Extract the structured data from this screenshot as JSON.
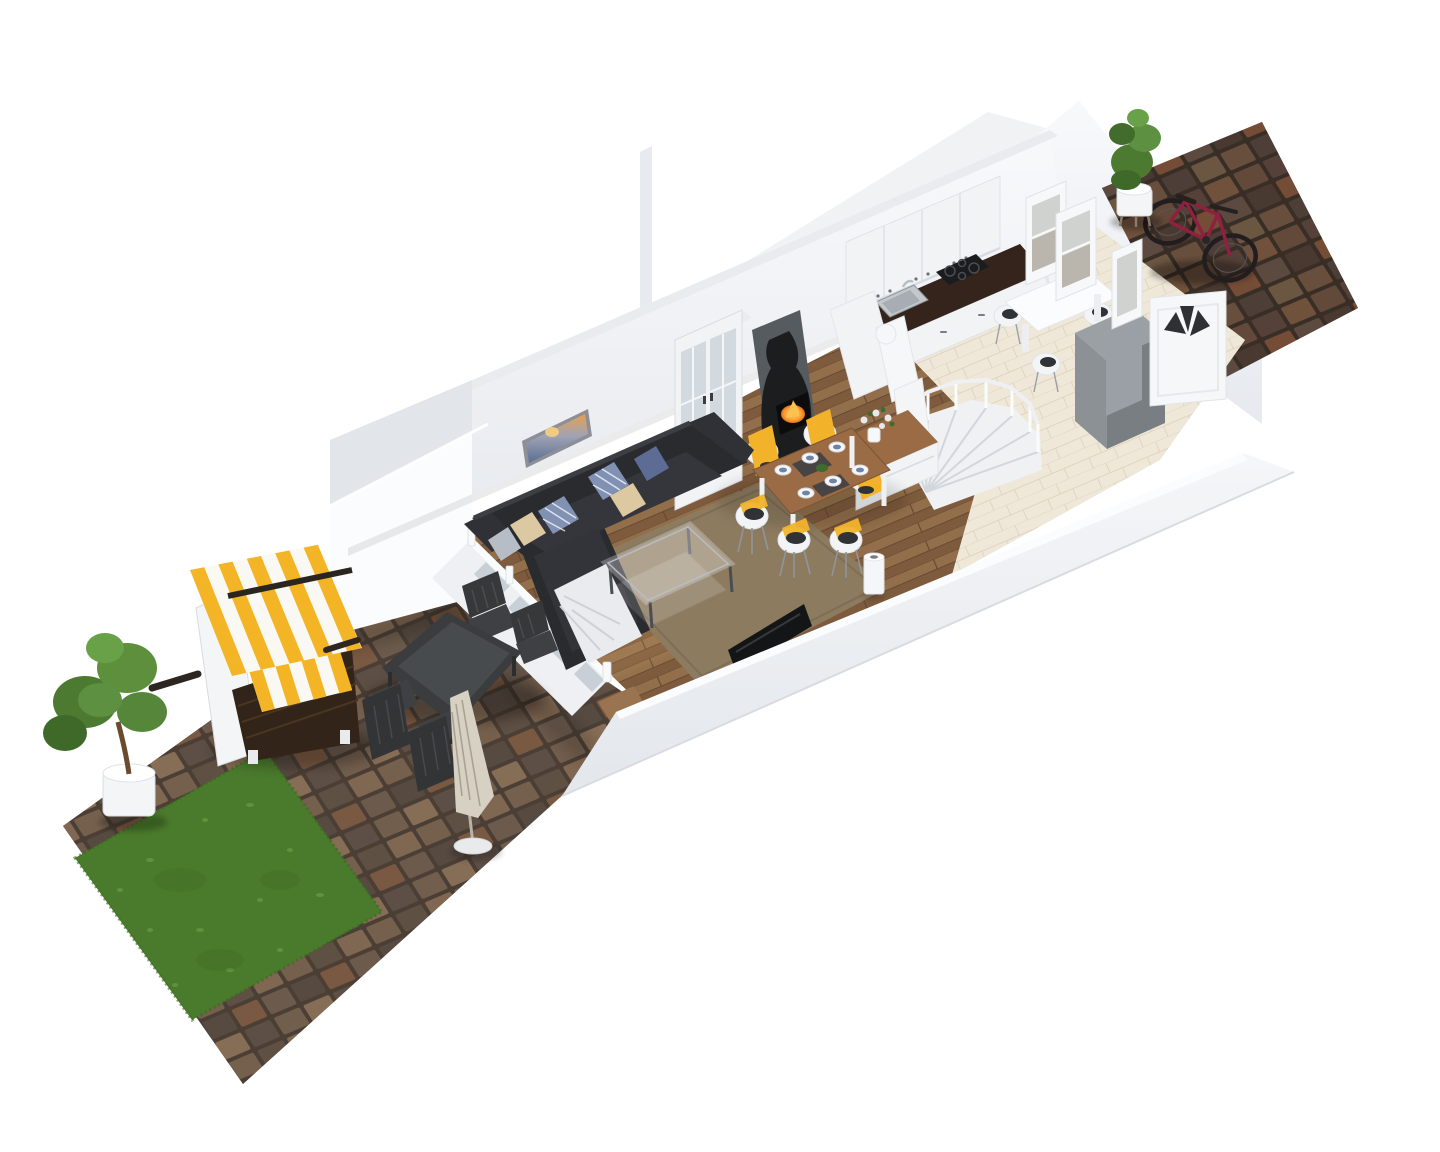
{
  "scene": {
    "description": "3D isometric floor-plan render of a narrow terraced-house ground floor, viewed diagonally from above: living room with corner sofa and dining set, kitchen with counter and spiral staircase, entrance path with bicycle, rear patio with outdoor dining set, beach chair and lawn",
    "background": "#ffffff"
  },
  "colors": {
    "wall": "#f3f4f6",
    "wall_top": "#e9ecef",
    "wall_shade": "#e2e6eb",
    "wall_bright": "#fbfcfd",
    "wood_floor": "#8a6646",
    "tile_floor": "#efe8d9",
    "rug": "#8d7b60",
    "sofa": "#2a2b2f",
    "sofa_cushion": "#35363b",
    "blanket": "#e9ebee",
    "pillow_blue": "#8091b4",
    "pillow_navy": "#5c6c94",
    "pillow_beige": "#dcc9a2",
    "pillow_gray": "#b6bdc6",
    "dining_table_wood": "#9a6b44",
    "sideboard_wood": "#9a6b44",
    "chair_shell": "#f3f4f6",
    "chair_yellow": "#f2b32b",
    "chair_seat_dark": "#2f3237",
    "counter_wood": "#34241c",
    "cabinet_white": "#f2f3f5",
    "stove_black": "#1c1d1f",
    "fire_orange": "#ff9b2e",
    "hearth_gray": "#565b5f",
    "fridge_gray": "#787e82",
    "fridge_top": "#9aa0a4",
    "fridge_side": "#8b9195",
    "stairs_white": "#eff1f3",
    "tv_black": "#141517",
    "lamp_white": "#f5f6f8",
    "picture_sky": "#e6a050",
    "picture_sea": "#5a6f92",
    "door_white": "#f6f7f9",
    "window_glass": "#cfd2cf",
    "interior_gray_wall": "#9aa0a5",
    "pavers_patio": "#584a3f",
    "pavers_path": "#3f332b",
    "grass": "#4a7a2c",
    "grass_light": "#6a9c42",
    "plant_green": "#4c7a31",
    "pot_white": "#f4f5f6",
    "strandkorb_yellow": "#f3b525",
    "strandkorb_white": "#faf8f2",
    "strandkorb_wicker": "#33241a",
    "outdoor_furniture": "#3a3c3e",
    "umbrella": "#d7d1c3",
    "bike_red": "#8e2040",
    "glass_cabinet": "#cdd5dc"
  },
  "rooms": [
    {
      "name": "living-room",
      "floor": "wood planks"
    },
    {
      "name": "dining-area",
      "floor": "wood planks"
    },
    {
      "name": "kitchen",
      "floor": "cream tile"
    },
    {
      "name": "entrance-path",
      "floor": "dark pavers"
    },
    {
      "name": "patio-garden",
      "floor": "stone pavers and lawn"
    }
  ],
  "objects": [
    {
      "name": "corner-sofa",
      "label": "dark corner sofa with plaid and knit pillows and white throw"
    },
    {
      "name": "coffee-table",
      "label": "glass coffee table"
    },
    {
      "name": "area-rug",
      "label": "brown area rug"
    },
    {
      "name": "tv",
      "label": "flat TV against front wall"
    },
    {
      "name": "floor-lamp",
      "label": "white cylinder floor lamp"
    },
    {
      "name": "wall-picture",
      "label": "sunset seascape picture"
    },
    {
      "name": "display-cabinet",
      "label": "white glass-door vitrine"
    },
    {
      "name": "wood-stove",
      "label": "black wood-burning stove with fire"
    },
    {
      "name": "dining-table",
      "label": "wood dining table set for six"
    },
    {
      "name": "dining-chairs",
      "label": "six white shell chairs with yellow cushions"
    },
    {
      "name": "sideboard",
      "label": "white sideboard with wood top and flower vase"
    },
    {
      "name": "kitchen-counter",
      "label": "white kitchen run with dark wood counter, sink and cooktop"
    },
    {
      "name": "kitchen-table",
      "label": "white kitchen table with four chairs"
    },
    {
      "name": "tall-gray-cabinet",
      "label": "tall gray cabinet"
    },
    {
      "name": "spiral-staircase",
      "label": "white winder staircase with railing"
    },
    {
      "name": "front-door",
      "label": "white front door with fanlight"
    },
    {
      "name": "bicycle",
      "label": "dark red bicycle on entrance path"
    },
    {
      "name": "entry-plant",
      "label": "potted plant at entrance"
    },
    {
      "name": "patio-table",
      "label": "dark outdoor dining table with four chairs"
    },
    {
      "name": "parasol",
      "label": "closed beige parasol"
    },
    {
      "name": "strandkorb",
      "label": "yellow and white striped beach chair"
    },
    {
      "name": "lawn",
      "label": "square lawn patch"
    },
    {
      "name": "garden-tree",
      "label": "potted tree in white planter"
    }
  ]
}
